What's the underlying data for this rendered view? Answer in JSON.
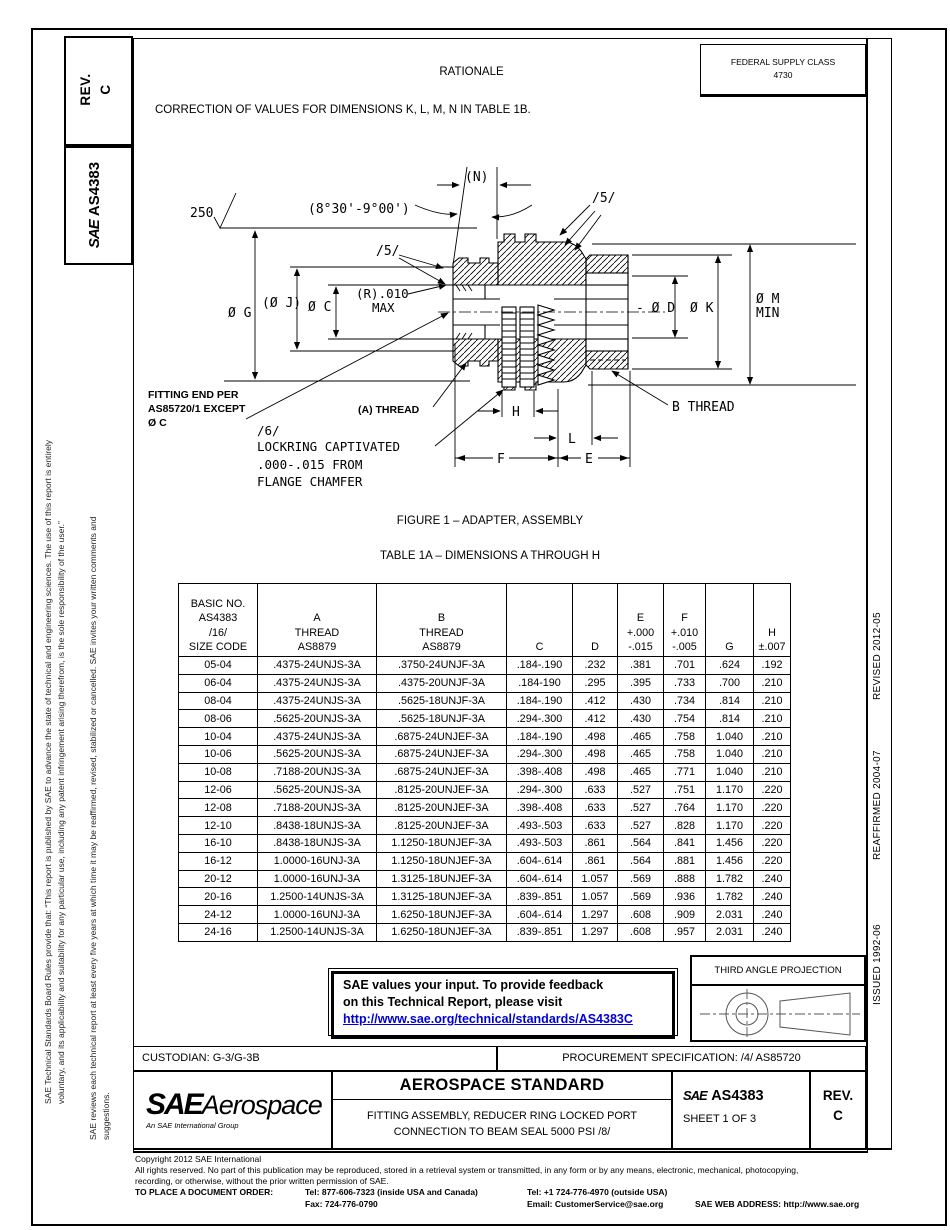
{
  "header": {
    "rationale_title": "RATIONALE",
    "correction_text": "CORRECTION OF VALUES FOR DIMENSIONS K, L, M, N IN TABLE 1B.",
    "fsc_label": "FEDERAL SUPPLY CLASS",
    "fsc_value": "4730"
  },
  "left_sidebar": {
    "rev_text": "REV.\nC",
    "logo": "SAE",
    "doc_number": "AS4383",
    "legal_text_1": "SAE Technical Standards Board Rules provide that: “This report is published by SAE to advance the state of technical and engineering sciences. The use of this report is entirely\nvoluntary, and its applicability and suitability for any particular use, including any patent infringement arising therefrom, is the sole responsibility of the user.”",
    "legal_text_2": "SAE reviews each technical report at least every five years at which time it may be reaffirmed, revised, stabilized or cancelled. SAE invites your written comments and\nsuggestions."
  },
  "right_sidebar": {
    "revised": "REVISED 2012-05",
    "reaffirmed": "REAFFIRMED 2004-07",
    "issued": "ISSUED 1992-06"
  },
  "figure": {
    "caption": "FIGURE 1 – ADAPTER, ASSEMBLY",
    "labels": {
      "surface_finish": "250",
      "angle": "(8°30'-9°00')",
      "n_dim": "(N)",
      "flag5_top": "/5/",
      "flag5_left": "/5/",
      "dia_g": "Ø G",
      "dia_j": "(Ø J)",
      "dia_c": "Ø C",
      "r_line1": "(R).010",
      "r_line2": "MAX",
      "dia_d": "- Ø D",
      "dia_k": "Ø K",
      "dia_m1": "Ø M",
      "dia_m2": "MIN",
      "fitting1": "FITTING END PER",
      "fitting2": "AS85720/1 EXCEPT",
      "fitting3": "Ø C",
      "a_thread": "(A) THREAD",
      "b_thread": "B THREAD",
      "flag6": "/6/",
      "lock1": "LOCKRING CAPTIVATED",
      "lock2": ".000-.015 FROM",
      "lock3": "FLANGE CHAMFER",
      "dim_h": "H",
      "dim_l": "L",
      "dim_f": "F",
      "dim_e": "E"
    }
  },
  "table": {
    "title": "TABLE 1A – DIMENSIONS A THROUGH H",
    "headers": [
      "BASIC NO.\nAS4383\n/16/\nSIZE CODE",
      "A\nTHREAD\nAS8879",
      "B\nTHREAD\nAS8879",
      "C",
      "D",
      "E\n+.000\n-.015",
      "F\n+.010\n-.005",
      "G",
      "H\n±.007"
    ],
    "rows": [
      [
        "05-04",
        ".4375-24UNJS-3A",
        ".3750-24UNJF-3A",
        ".184-.190",
        ".232",
        ".381",
        ".701",
        ".624",
        ".192"
      ],
      [
        "06-04",
        ".4375-24UNJS-3A",
        ".4375-20UNJF-3A",
        ".184-190",
        ".295",
        ".395",
        ".733",
        ".700",
        ".210"
      ],
      [
        "08-04",
        ".4375-24UNJS-3A",
        ".5625-18UNJF-3A",
        ".184-.190",
        ".412",
        ".430",
        ".734",
        ".814",
        ".210"
      ],
      [
        "08-06",
        ".5625-20UNJS-3A",
        ".5625-18UNJF-3A",
        ".294-.300",
        ".412",
        ".430",
        ".754",
        ".814",
        ".210"
      ],
      [
        "10-04",
        ".4375-24UNJS-3A",
        ".6875-24UNJEF-3A",
        ".184-.190",
        ".498",
        ".465",
        ".758",
        "1.040",
        ".210"
      ],
      [
        "10-06",
        ".5625-20UNJS-3A",
        ".6875-24UNJEF-3A",
        ".294-.300",
        ".498",
        ".465",
        ".758",
        "1.040",
        ".210"
      ],
      [
        "10-08",
        ".7188-20UNJS-3A",
        ".6875-24UNJEF-3A",
        ".398-.408",
        ".498",
        ".465",
        ".771",
        "1.040",
        ".210"
      ],
      [
        "12-06",
        ".5625-20UNJS-3A",
        ".8125-20UNJEF-3A",
        ".294-.300",
        ".633",
        ".527",
        ".751",
        "1.170",
        ".220"
      ],
      [
        "12-08",
        ".7188-20UNJS-3A",
        ".8125-20UNJEF-3A",
        ".398-.408",
        ".633",
        ".527",
        ".764",
        "1.170",
        ".220"
      ],
      [
        "12-10",
        ".8438-18UNJS-3A",
        ".8125-20UNJEF-3A",
        ".493-.503",
        ".633",
        ".527",
        ".828",
        "1.170",
        ".220"
      ],
      [
        "16-10",
        ".8438-18UNJS-3A",
        "1.1250-18UNJEF-3A",
        ".493-.503",
        ".861",
        ".564",
        ".841",
        "1.456",
        ".220"
      ],
      [
        "16-12",
        "1.0000-16UNJ-3A",
        "1.1250-18UNJEF-3A",
        ".604-.614",
        ".861",
        ".564",
        ".881",
        "1.456",
        ".220"
      ],
      [
        "20-12",
        "1.0000-16UNJ-3A",
        "1.3125-18UNJEF-3A",
        ".604-.614",
        "1.057",
        ".569",
        ".888",
        "1.782",
        ".240"
      ],
      [
        "20-16",
        "1.2500-14UNJS-3A",
        "1.3125-18UNJEF-3A",
        ".839-.851",
        "1.057",
        ".569",
        ".936",
        "1.782",
        ".240"
      ],
      [
        "24-12",
        "1.0000-16UNJ-3A",
        "1.6250-18UNJEF-3A",
        ".604-.614",
        "1.297",
        ".608",
        ".909",
        "2.031",
        ".240"
      ],
      [
        "24-16",
        "1.2500-14UNJS-3A",
        "1.6250-18UNJEF-3A",
        ".839-.851",
        "1.297",
        ".608",
        ".957",
        "2.031",
        ".240"
      ]
    ]
  },
  "feedback": {
    "line1": "SAE values your input. To provide feedback",
    "line2": "on this Technical Report, please visit",
    "link": "http://www.sae.org/technical/standards/AS4383C"
  },
  "projection": {
    "label": "THIRD ANGLE PROJECTION"
  },
  "custodian": "CUSTODIAN: G-3/G-3B",
  "procurement": "PROCUREMENT SPECIFICATION: /4/ AS85720",
  "title_block": {
    "logo_main": "SAE",
    "logo_sub": "Aerospace",
    "logo_tagline": "An SAE International Group",
    "standard_type": "AEROSPACE STANDARD",
    "subtitle1": "FITTING ASSEMBLY, REDUCER RING LOCKED PORT",
    "subtitle2": "CONNECTION TO BEAM SEAL 5000 PSI /8/",
    "doc_logo": "SAE",
    "doc_number": "AS4383",
    "sheet": "SHEET 1 OF 3",
    "rev_text": "REV.\nC"
  },
  "copyright": {
    "line1": "Copyright 2012 SAE International",
    "line2": "All rights reserved. No part of this publication may be reproduced, stored in a retrieval system or transmitted, in any form or by any means, electronic, mechanical, photocopying,",
    "line3": "recording, or otherwise, without the prior written permission of SAE.",
    "order_label": "TO PLACE A DOCUMENT ORDER:",
    "tel1": "Tel: 877-606-7323 (inside USA and Canada)",
    "tel2": "Tel: +1 724-776-4970 (outside USA)",
    "fax": "Fax: 724-776-0790",
    "email": "Email: CustomerService@sae.org",
    "web": "SAE WEB ADDRESS: http://www.sae.org"
  }
}
